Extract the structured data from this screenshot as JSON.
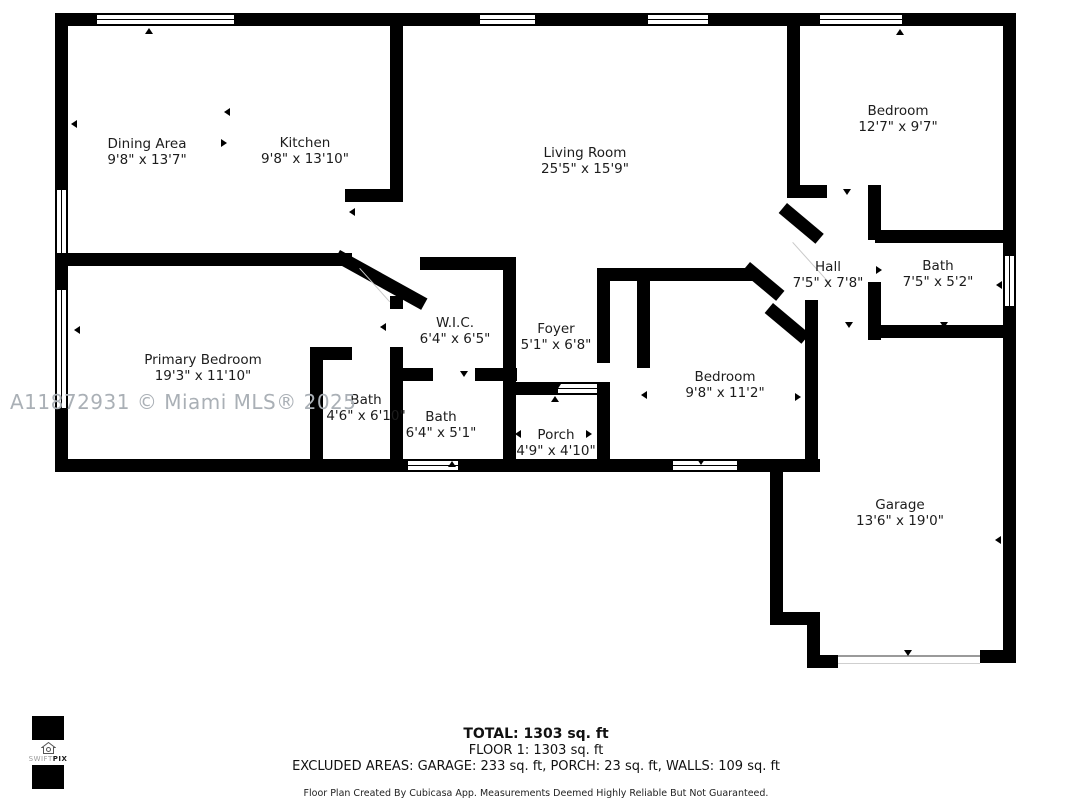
{
  "floorplan": {
    "watermark": "A11872931 © Miami MLS® 2025",
    "rooms": [
      {
        "name": "Dining Area",
        "dims": "9'8\" x 13'7\""
      },
      {
        "name": "Kitchen",
        "dims": "9'8\" x 13'10\""
      },
      {
        "name": "Living Room",
        "dims": "25'5\" x 15'9\""
      },
      {
        "name": "Bedroom",
        "dims": "12'7\" x 9'7\""
      },
      {
        "name": "Hall",
        "dims": "7'5\" x 7'8\""
      },
      {
        "name": "Bath",
        "dims": "7'5\" x 5'2\""
      },
      {
        "name": "W.I.C.",
        "dims": "6'4\" x 6'5\""
      },
      {
        "name": "Foyer",
        "dims": "5'1\" x 6'8\""
      },
      {
        "name": "Primary Bedroom",
        "dims": "19'3\" x 11'10\""
      },
      {
        "name": "Bath",
        "dims": "4'6\" x 6'10\""
      },
      {
        "name": "Bath",
        "dims": "6'4\" x 5'1\""
      },
      {
        "name": "Porch",
        "dims": "4'9\" x 4'10\""
      },
      {
        "name": "Bedroom",
        "dims": "9'8\" x 11'2\""
      },
      {
        "name": "Garage",
        "dims": "13'6\" x 19'0\""
      }
    ],
    "footer": {
      "total": "TOTAL: 1303 sq. ft",
      "floor": "FLOOR 1: 1303 sq. ft",
      "excluded": "EXCLUDED AREAS: GARAGE: 233 sq. ft, PORCH: 23 sq. ft, WALLS: 109 sq. ft",
      "disclaimer": "Floor Plan Created By Cubicasa App. Measurements Deemed Highly Reliable But Not Guaranteed."
    },
    "logo": {
      "brand_part1": "SWIFT",
      "brand_part2": "PIX"
    },
    "colors": {
      "wall": "#000000",
      "watermark": "#aab0b6",
      "text": "#1c1c1c"
    }
  }
}
